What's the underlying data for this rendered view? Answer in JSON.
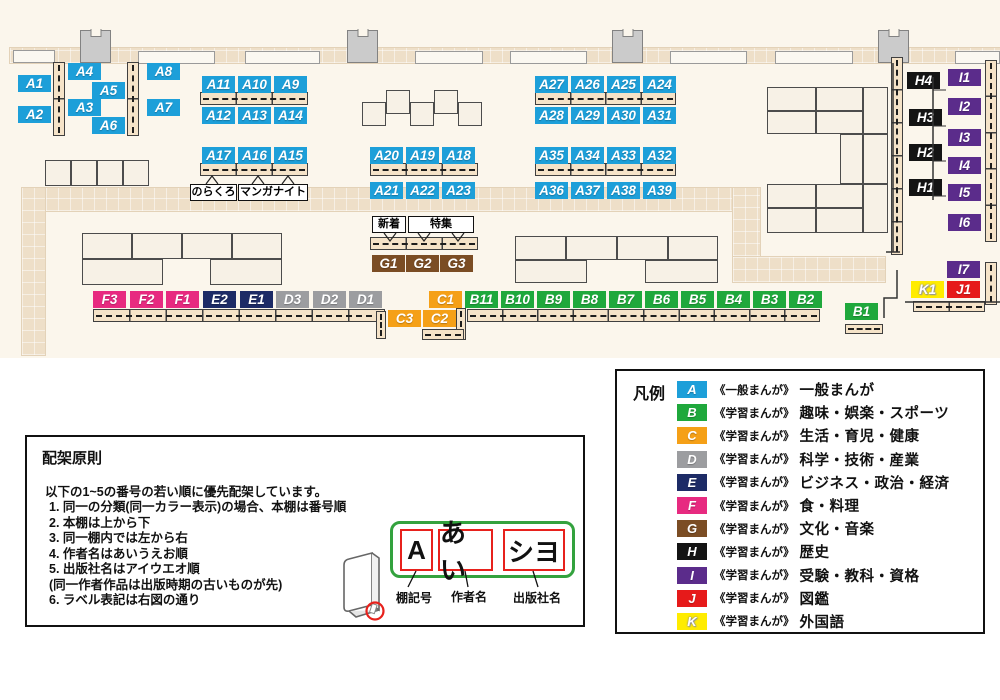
{
  "colors": {
    "A": "#1D9FD9",
    "B": "#1FA83C",
    "C": "#F5A017",
    "D": "#9C9DA0",
    "E": "#1D2B66",
    "F": "#E72A80",
    "G": "#7B4D24",
    "H": "#141414",
    "I": "#5B2C8B",
    "J": "#E61A1A",
    "K": "#FFEC00"
  },
  "map": {
    "labels": [
      [
        "A1",
        18,
        75
      ],
      [
        "A2",
        18,
        106
      ],
      [
        "A4",
        68,
        63
      ],
      [
        "A5",
        92,
        82
      ],
      [
        "A3",
        68,
        99
      ],
      [
        "A6",
        92,
        117
      ],
      [
        "A8",
        147,
        63
      ],
      [
        "A7",
        147,
        99
      ],
      [
        "A11",
        202,
        76
      ],
      [
        "A10",
        238,
        76
      ],
      [
        "A9",
        274,
        76
      ],
      [
        "A12",
        202,
        107
      ],
      [
        "A13",
        238,
        107
      ],
      [
        "A14",
        274,
        107
      ],
      [
        "A17",
        202,
        147
      ],
      [
        "A16",
        238,
        147
      ],
      [
        "A15",
        274,
        147
      ],
      [
        "A20",
        370,
        147
      ],
      [
        "A19",
        406,
        147
      ],
      [
        "A18",
        442,
        147
      ],
      [
        "A21",
        370,
        182
      ],
      [
        "A22",
        406,
        182
      ],
      [
        "A23",
        442,
        182
      ],
      [
        "A27",
        535,
        76
      ],
      [
        "A26",
        571,
        76
      ],
      [
        "A25",
        607,
        76
      ],
      [
        "A24",
        643,
        76
      ],
      [
        "A28",
        535,
        107
      ],
      [
        "A29",
        571,
        107
      ],
      [
        "A30",
        607,
        107
      ],
      [
        "A31",
        643,
        107
      ],
      [
        "A35",
        535,
        147
      ],
      [
        "A34",
        571,
        147
      ],
      [
        "A33",
        607,
        147
      ],
      [
        "A32",
        643,
        147
      ],
      [
        "A36",
        535,
        182
      ],
      [
        "A37",
        571,
        182
      ],
      [
        "A38",
        607,
        182
      ],
      [
        "A39",
        643,
        182
      ],
      [
        "G1",
        372,
        255
      ],
      [
        "G2",
        406,
        255
      ],
      [
        "G3",
        440,
        255
      ],
      [
        "F3",
        93,
        291
      ],
      [
        "F2",
        130,
        291
      ],
      [
        "F1",
        166,
        291
      ],
      [
        "E2",
        203,
        291
      ],
      [
        "E1",
        240,
        291
      ],
      [
        "D3",
        276,
        291
      ],
      [
        "D2",
        313,
        291
      ],
      [
        "D1",
        349,
        291
      ],
      [
        "C1",
        429,
        291
      ],
      [
        "B11",
        465,
        291
      ],
      [
        "B10",
        501,
        291
      ],
      [
        "B9",
        537,
        291
      ],
      [
        "B8",
        573,
        291
      ],
      [
        "B7",
        609,
        291
      ],
      [
        "B6",
        645,
        291
      ],
      [
        "B5",
        681,
        291
      ],
      [
        "B4",
        717,
        291
      ],
      [
        "B3",
        753,
        291
      ],
      [
        "B2",
        789,
        291
      ],
      [
        "C3",
        388,
        310
      ],
      [
        "C2",
        423,
        310
      ],
      [
        "B1",
        845,
        303
      ],
      [
        "H4",
        907,
        72
      ],
      [
        "H3",
        909,
        109
      ],
      [
        "H2",
        909,
        144
      ],
      [
        "H1",
        909,
        179
      ],
      [
        "I1",
        948,
        69
      ],
      [
        "I2",
        948,
        98
      ],
      [
        "I3",
        948,
        129
      ],
      [
        "I4",
        948,
        157
      ],
      [
        "I5",
        948,
        184
      ],
      [
        "I6",
        948,
        214
      ],
      [
        "I7",
        947,
        261
      ],
      [
        "K1",
        911,
        281
      ],
      [
        "J1",
        947,
        281
      ]
    ],
    "callouts": [
      [
        "のらくろ",
        190,
        184,
        47,
        17
      ],
      [
        "マンガナイト",
        238,
        184,
        70,
        17
      ],
      [
        "新着",
        372,
        216,
        34,
        17
      ],
      [
        "特集",
        408,
        216,
        66,
        17
      ]
    ],
    "shelves": [
      [
        53,
        62,
        12,
        74,
        "v",
        2
      ],
      [
        127,
        62,
        12,
        74,
        "v",
        2
      ],
      [
        200,
        92,
        108,
        13,
        "h",
        3
      ],
      [
        200,
        163,
        108,
        13,
        "h",
        3
      ],
      [
        370,
        163,
        108,
        13,
        "h",
        3
      ],
      [
        535,
        92,
        141,
        13,
        "h",
        4
      ],
      [
        535,
        163,
        141,
        13,
        "h",
        4
      ],
      [
        370,
        237,
        108,
        13,
        "h",
        3
      ],
      [
        93,
        309,
        292,
        13,
        "h",
        8
      ],
      [
        376,
        311,
        10,
        28,
        "v",
        1
      ],
      [
        456,
        308,
        10,
        32,
        "v",
        1
      ],
      [
        467,
        309,
        353,
        13,
        "h",
        10
      ],
      [
        422,
        329,
        42,
        11,
        "h",
        1
      ],
      [
        845,
        324,
        38,
        10,
        "h",
        1
      ],
      [
        913,
        301,
        72,
        11,
        "h",
        2
      ],
      [
        891,
        57,
        12,
        198,
        "v",
        6
      ],
      [
        985,
        60,
        12,
        182,
        "v",
        5
      ],
      [
        985,
        262,
        12,
        43,
        "v",
        1
      ]
    ],
    "tables": [
      [
        45,
        160,
        26,
        26
      ],
      [
        71,
        160,
        26,
        26
      ],
      [
        97,
        160,
        26,
        26
      ],
      [
        123,
        160,
        26,
        26
      ],
      [
        82,
        233,
        50,
        26
      ],
      [
        132,
        233,
        50,
        26
      ],
      [
        182,
        233,
        50,
        26
      ],
      [
        232,
        233,
        50,
        26
      ],
      [
        82,
        259,
        81,
        26
      ],
      [
        210,
        259,
        72,
        26
      ],
      [
        362,
        102,
        24,
        24
      ],
      [
        386,
        90,
        24,
        24
      ],
      [
        410,
        102,
        24,
        24
      ],
      [
        434,
        90,
        24,
        24
      ],
      [
        458,
        102,
        24,
        24
      ],
      [
        515,
        236,
        51,
        24
      ],
      [
        566,
        236,
        51,
        24
      ],
      [
        617,
        236,
        51,
        24
      ],
      [
        668,
        236,
        50,
        24
      ],
      [
        515,
        260,
        72,
        23
      ],
      [
        645,
        260,
        73,
        23
      ],
      [
        767,
        87,
        49,
        24
      ],
      [
        816,
        87,
        47,
        24
      ],
      [
        767,
        111,
        49,
        23
      ],
      [
        816,
        111,
        47,
        23
      ],
      [
        863,
        87,
        25,
        47
      ],
      [
        840,
        134,
        23,
        50
      ],
      [
        863,
        134,
        25,
        50
      ],
      [
        767,
        184,
        49,
        24
      ],
      [
        816,
        184,
        47,
        24
      ],
      [
        767,
        208,
        49,
        25
      ],
      [
        816,
        208,
        47,
        25
      ],
      [
        863,
        184,
        25,
        49
      ]
    ],
    "pillars": [
      [
        80,
        30
      ],
      [
        347,
        30
      ],
      [
        612,
        30
      ],
      [
        878,
        30
      ]
    ],
    "wall_rects": [
      [
        13,
        50,
        42,
        13
      ],
      [
        138,
        51,
        77,
        13
      ],
      [
        245,
        51,
        75,
        13
      ],
      [
        415,
        51,
        68,
        13
      ],
      [
        510,
        51,
        77,
        13
      ],
      [
        670,
        51,
        77,
        13
      ],
      [
        775,
        51,
        78,
        13
      ],
      [
        955,
        51,
        45,
        13
      ]
    ],
    "walkways": [
      [
        10,
        48,
        990,
        15
      ],
      [
        22,
        188,
        738,
        23
      ],
      [
        733,
        188,
        27,
        92
      ],
      [
        733,
        257,
        152,
        25
      ],
      [
        22,
        188,
        23,
        167
      ]
    ]
  },
  "legend": {
    "title": "凡例",
    "rows": [
      {
        "key": "A",
        "prefix": "《一般まんが》",
        "label": "一般まんが"
      },
      {
        "key": "B",
        "prefix": "《学習まんが》",
        "label": "趣味・娯楽・スポーツ"
      },
      {
        "key": "C",
        "prefix": "《学習まんが》",
        "label": "生活・育児・健康"
      },
      {
        "key": "D",
        "prefix": "《学習まんが》",
        "label": "科学・技術・産業"
      },
      {
        "key": "E",
        "prefix": "《学習まんが》",
        "label": "ビジネス・政治・経済"
      },
      {
        "key": "F",
        "prefix": "《学習まんが》",
        "label": "食・料理"
      },
      {
        "key": "G",
        "prefix": "《学習まんが》",
        "label": "文化・音楽"
      },
      {
        "key": "H",
        "prefix": "《学習まんが》",
        "label": "歴史"
      },
      {
        "key": "I",
        "prefix": "《学習まんが》",
        "label": "受験・教科・資格"
      },
      {
        "key": "J",
        "prefix": "《学習まんが》",
        "label": "図鑑"
      },
      {
        "key": "K",
        "prefix": "《学習まんが》",
        "label": "外国語"
      }
    ]
  },
  "principles": {
    "title": "配架原則",
    "intro": "以下の1~5の番号の若い順に優先配架しています。",
    "items": [
      "1. 同一の分類(同一カラー表示)の場合、本棚は番号順",
      "2. 本棚は上から下",
      "3. 同一棚内では左から右",
      "4. 作者名はあいうえお順",
      "5. 出版社名はアイウエオ順\n    (同一作者作品は出版時期の古いものが先)",
      "6. ラベル表記は右図の通り"
    ],
    "diagram": {
      "boxes": [
        "A",
        "あい",
        "シヨ"
      ],
      "labels": [
        "棚記号",
        "作者名",
        "出版社名"
      ]
    }
  }
}
